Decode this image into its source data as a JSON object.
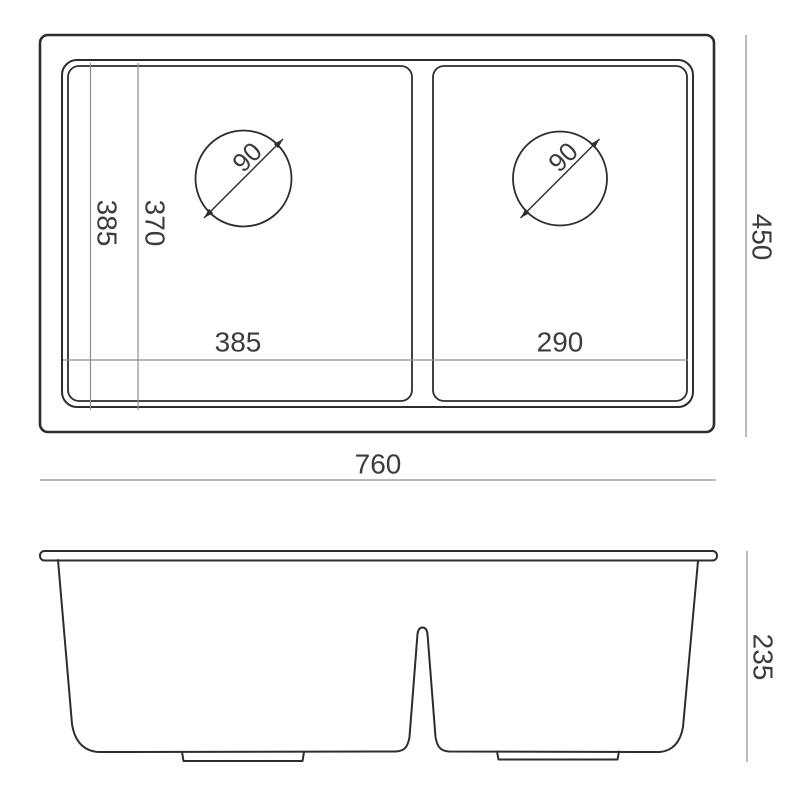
{
  "drawing": {
    "type": "kitchen-sink-technical-drawing",
    "views": [
      "top-view",
      "side-view"
    ]
  },
  "colors": {
    "line": "#2d2d2d",
    "dimension_line": "#909090",
    "label_text": "#3c3c3c",
    "background": "#ffffff"
  },
  "top_view": {
    "overall_width_mm": "760",
    "overall_depth_mm": "450",
    "left_bowl_width_mm": "385",
    "right_bowl_width_mm": "290",
    "bowl_depth_outer_mm": "385",
    "bowl_depth_inner_mm": "370",
    "left_drain_diameter_mm": "90",
    "right_drain_diameter_mm": "90"
  },
  "side_view": {
    "height_mm": "235"
  }
}
